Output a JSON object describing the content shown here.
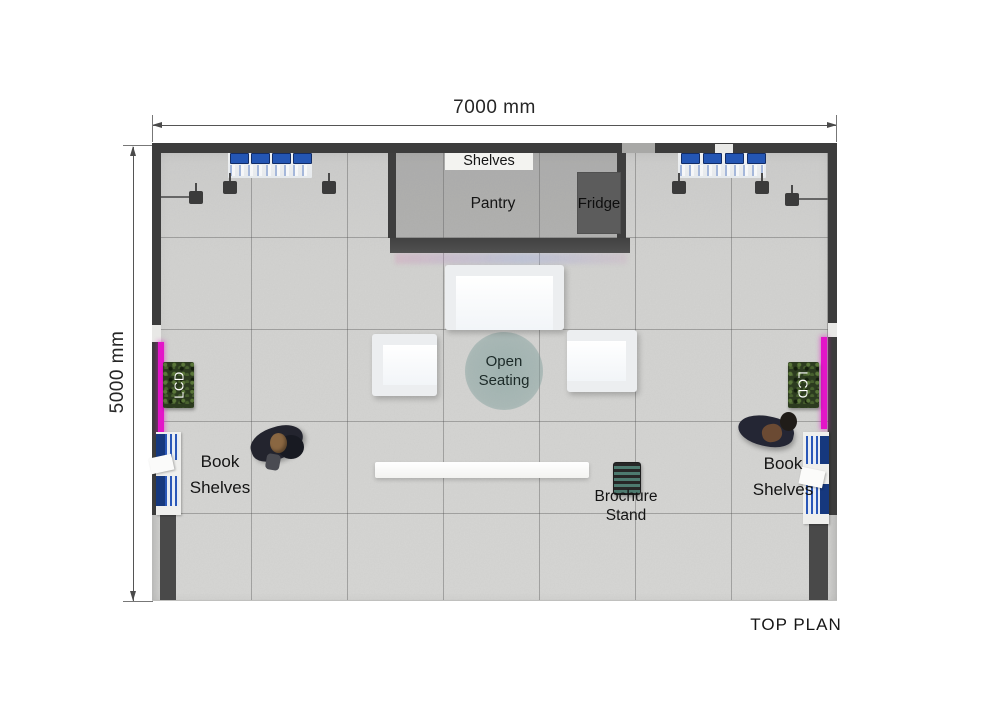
{
  "plan": {
    "title": "TOP PLAN",
    "dimensions": {
      "width": "7000 mm",
      "height": "5000 mm"
    },
    "pantry": {
      "label": "Pantry",
      "shelves": "Shelves",
      "fridge": "Fridge"
    },
    "open_seating": {
      "line1": "Open",
      "line2": "Seating"
    },
    "lcd_left": "LCD",
    "lcd_right": "LCD",
    "book_shelves_left": {
      "line1": "Book",
      "line2": "Shelves"
    },
    "book_shelves_right": {
      "line1": "Book",
      "line2": "Shelves"
    },
    "brochure_stand": {
      "line1": "Brochure",
      "line2": "Stand"
    },
    "colors": {
      "wall": "#3c3c3c",
      "floor": "#d3d3d1",
      "lcd_accent": "#e315c8",
      "plant_green": "#2c3b1f",
      "monitor_blue": "#2456b4",
      "rug_teal": "#8fb0ad",
      "fridge_gray": "#5c5c5c"
    }
  }
}
